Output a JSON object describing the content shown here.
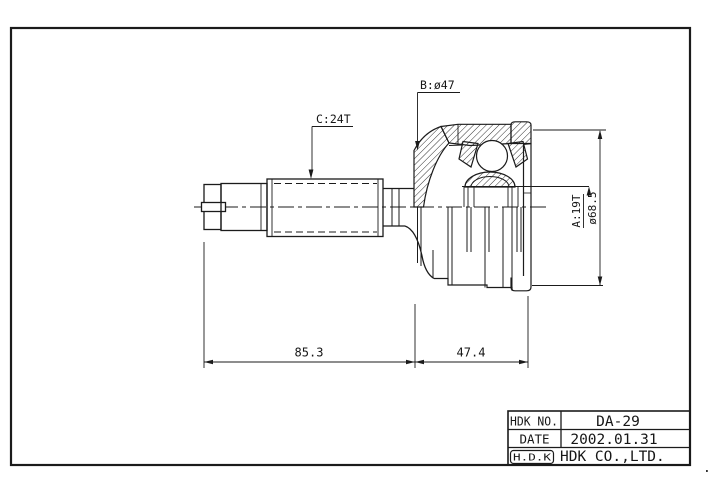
{
  "frame": {
    "line_color": "#1b1b1b",
    "paper_color": "#ffffff"
  },
  "drawing": {
    "type": "cv-joint-outer-race-technical-drawing",
    "annotations": {
      "label_spline_c": "C:24T",
      "label_diameter_b": "B:ø47",
      "label_spline_a": "A:19T",
      "label_outer_diameter": "ø68.5",
      "dim_shaft_length": "85.3",
      "dim_housing_length": "47.4"
    }
  },
  "title_block": {
    "rows": [
      {
        "label": "HDK NO.",
        "value": "DA-29"
      },
      {
        "label": "DATE",
        "value": "2002.01.31"
      },
      {
        "label": "H.D.K",
        "value": "HDK CO.,LTD."
      }
    ]
  },
  "stray_mark": "."
}
